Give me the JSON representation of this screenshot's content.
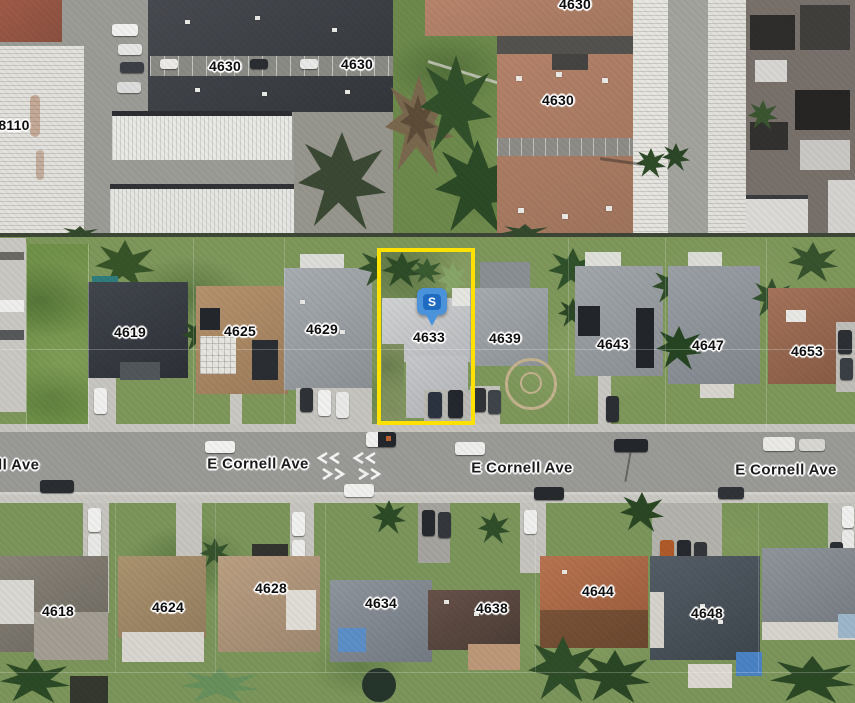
{
  "map": {
    "view_type": "satellite-aerial",
    "street_labels": [
      "ll Ave",
      "E Cornell Ave",
      "E Cornell Ave",
      "E Cornell Ave"
    ],
    "parcel_labels": [
      "8110",
      "4630",
      "4630",
      "4630",
      "4630",
      "4619",
      "4625",
      "4629",
      "4633",
      "4639",
      "4643",
      "4647",
      "4653",
      "4618",
      "4624",
      "4628",
      "4634",
      "4638",
      "4644",
      "4648"
    ],
    "highlight": {
      "parcel_number": "4633",
      "outline_color": "#FFE100"
    },
    "marker": {
      "letter": "S",
      "shape": "rounded-square-pin",
      "outer_color": "#4A93DA",
      "inner_color": "#1F6BC1",
      "letter_color": "#FFFFFF"
    }
  }
}
